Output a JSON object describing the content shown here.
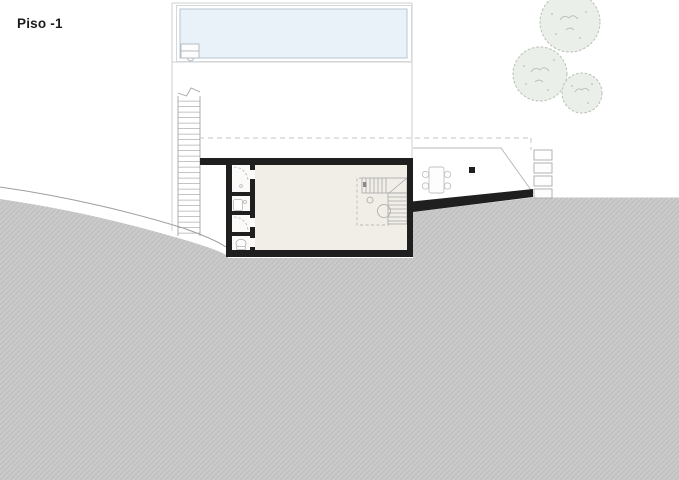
{
  "plan": {
    "title": "Piso -1",
    "colors": {
      "wall": "#1f1f1f",
      "terrain_base": "#cacaca",
      "terrain_hatch": "#bcbcbc",
      "pool_water": "#e9f2f8",
      "pool_edge": "#b9c7cf",
      "floor_main": "#f1eee8",
      "room_floor": "#fbfaf9",
      "tree_fill": "#ebefe9",
      "tree_stroke": "#b7c1b3",
      "outline_light": "#cdd0d2",
      "detail_gray": "#a8a8a8",
      "dash_gray": "#c6c6c6",
      "contour_line": "#9e9e9e"
    }
  }
}
